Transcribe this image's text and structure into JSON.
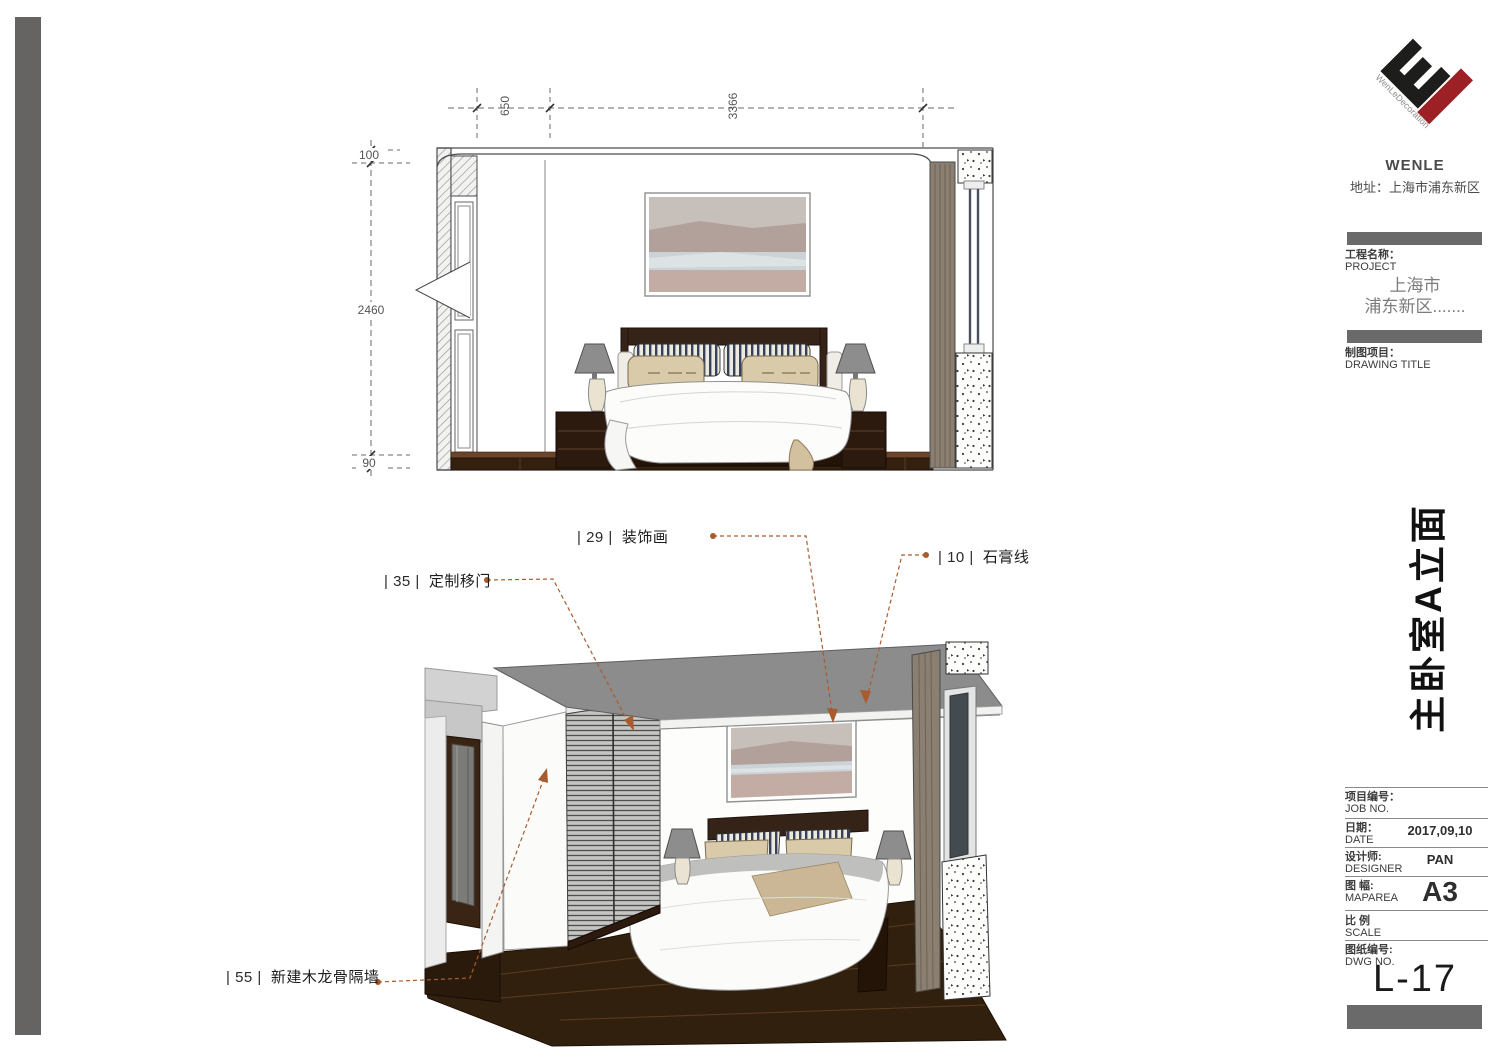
{
  "logo": {
    "brand_diagonal_text": "WenLeDecoration",
    "company": "WENLE",
    "address": "地址：上海市浦东新区",
    "black": "#1d1d1b",
    "red": "#9c2025"
  },
  "title_block": {
    "project_label_cn": "工程名称：",
    "project_label_en": "PROJECT",
    "project_value_line1": "上海市",
    "project_value_line2": "浦东新区.......",
    "drawing_title_label_cn": "制图项目：",
    "drawing_title_label_en": "DRAWING TITLE",
    "drawing_title_vertical": "主卧室A立面",
    "rows": [
      {
        "cn": "项目编号：",
        "en": "JOB NO.",
        "value": ""
      },
      {
        "cn": "日期：",
        "en": "DATE",
        "value": "2017,09,10"
      },
      {
        "cn": "设计师:",
        "en": "DESIGNER",
        "value": "PAN"
      },
      {
        "cn": "图 幅:",
        "en": "MAPAREA",
        "value": "A3"
      },
      {
        "cn": "比 例",
        "en": "SCALE",
        "value": ""
      },
      {
        "cn": "图纸编号:",
        "en": "DWG NO.",
        "value": ""
      }
    ],
    "dwg_no": "L-17"
  },
  "dimensions": {
    "top": [
      "650",
      "3366"
    ],
    "left": [
      "100",
      "2460",
      "90"
    ]
  },
  "callouts": [
    {
      "prefix": "| 29 |",
      "label": "装饰画"
    },
    {
      "prefix": "| 10 |",
      "label": "石膏线"
    },
    {
      "prefix": "| 35 |",
      "label": "定制移门"
    },
    {
      "prefix": "| 55 |",
      "label": "新建木龙骨隔墙"
    }
  ],
  "colors": {
    "leader": "#a85c2e",
    "sidebar_bar": "#6a6a6a",
    "edge_bar": "#666462",
    "ceiling": "#8c8c8c",
    "wood_dark": "#2c1a0e",
    "floor": "#32200f",
    "lamp_shade": "#8d8d8d",
    "pillow_beige": "#d9caaa",
    "curtain": "#8b7f71"
  }
}
